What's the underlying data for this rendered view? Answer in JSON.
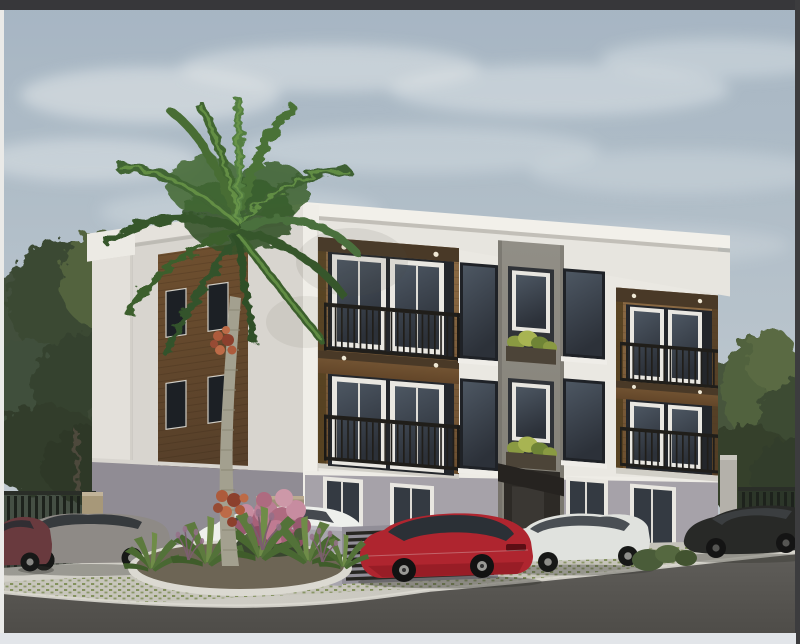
{
  "meta": {
    "description": "3D architectural rendering of a modern three-story apartment building with two wood-clad balcony modules, a central gray stone column with planter recesses, a tall royal palm tree, a curbed landscape island with agaves and a pink flowering bush, and six cars parked along an asphalt street under a hazy blue sky",
    "visible_text": "none"
  },
  "colors": {
    "frame_top": "#37373a",
    "frame_right": "#3c3c3e",
    "frame_left": "#eaeae8",
    "frame_bottom": "#e2e5e9",
    "sky_top": "#a5b5c4",
    "sky_mid": "#b9c4cc",
    "sky_bottom": "#c8cfd2",
    "cloud": "#e6eaea",
    "facade_white": "#eae8e2",
    "facade_shade": "#d8d5cf",
    "parapet_cap": "#f2f0ea",
    "wood_light": "#8d6b43",
    "wood_dark": "#6d4f2e",
    "stone_light": "#918e86",
    "stone_dark": "#7c796f",
    "ground_band": "#a6a2a9",
    "railing": "#201e1a",
    "window_glass": "#3a424e",
    "pavement_light": "#d3d1c9",
    "pavement_dark": "#c1bfb7",
    "curb": "#dbd9d1",
    "road_light": "#605e5a",
    "road_dark": "#4e4c48",
    "island_soil": "#6d6554",
    "agave": "#5c7a3c",
    "bush_pink": "#b06a80",
    "palm_trunk": "#a3a08e",
    "palm_green": "#40662f",
    "palm_red": "#b05a3a",
    "tree_green": "#42503a",
    "fence": "#1d221c"
  },
  "scene": {
    "sky": {
      "clouds": 9
    },
    "building": {
      "floors": 3,
      "balcony_modules": 2,
      "balconies_per_module": 2,
      "planter_recesses": 2,
      "ground_windows": 4
    },
    "vehicles": [
      {
        "id": "car-maroon",
        "color": "#6a3a3e",
        "position": "far left, partially out of frame"
      },
      {
        "id": "car-gray",
        "color": "#8e8a86",
        "position": "left"
      },
      {
        "id": "car-white-van",
        "color": "#eef0ec",
        "position": "center-left, behind palm"
      },
      {
        "id": "car-red",
        "color": "#b3242e",
        "position": "center"
      },
      {
        "id": "car-silver",
        "color": "#e0e2de",
        "position": "center-right"
      },
      {
        "id": "car-black",
        "color": "#282927",
        "position": "right"
      }
    ],
    "vegetation": {
      "palm_trees": 1,
      "pink_bushes": 1,
      "agave_clusters": 5,
      "grass_plumes": 3,
      "background_trees": "left and right"
    },
    "site": {
      "fence": "dark metal fence left and right",
      "enclosure": "gray utility enclosure with dark slats",
      "road": "asphalt street, foreground",
      "island": "curbed landscape island"
    }
  }
}
